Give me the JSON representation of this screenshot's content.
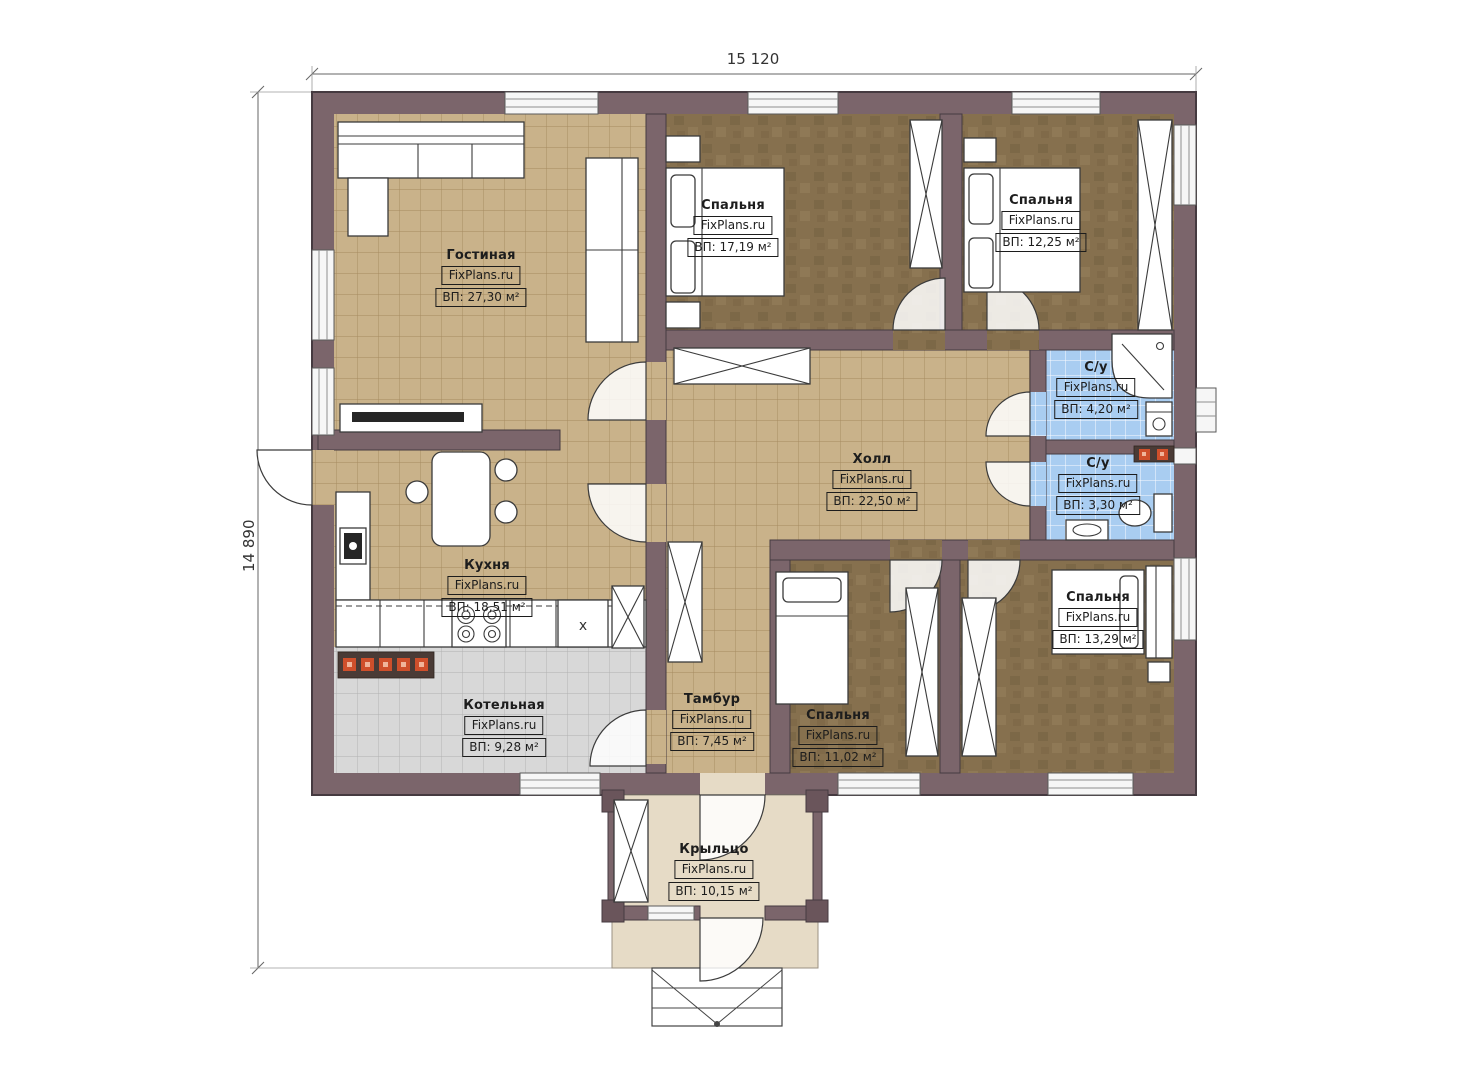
{
  "dimensions": {
    "width": "15 120",
    "height": "14 890"
  },
  "watermark": "FixPlans.ru",
  "kitchen_marker": "x",
  "rooms": [
    {
      "key": "living",
      "name": "Гостиная",
      "area": "ВП: 27,30 м²"
    },
    {
      "key": "bedroom-1",
      "name": "Спальня",
      "area": "ВП: 17,19 м²"
    },
    {
      "key": "bedroom-2",
      "name": "Спальня",
      "area": "ВП: 12,25 м²"
    },
    {
      "key": "bath-1",
      "name": "С/у",
      "area": "ВП: 4,20 м²"
    },
    {
      "key": "bath-2",
      "name": "С/у",
      "area": "ВП: 3,30 м²"
    },
    {
      "key": "hall",
      "name": "Холл",
      "area": "ВП: 22,50 м²"
    },
    {
      "key": "kitchen",
      "name": "Кухня",
      "area": "ВП: 18,51 м²"
    },
    {
      "key": "boiler",
      "name": "Котельная",
      "area": "ВП: 9,28 м²"
    },
    {
      "key": "vestibule",
      "name": "Тамбур",
      "area": "ВП: 7,45 м²"
    },
    {
      "key": "bedroom-3",
      "name": "Спальня",
      "area": "ВП: 11,02 м²"
    },
    {
      "key": "bedroom-4",
      "name": "Спальня",
      "area": "ВП: 13,29 м²"
    },
    {
      "key": "porch",
      "name": "Крыльцо",
      "area": "ВП: 10,15 м²"
    }
  ],
  "colors": {
    "wall": "#7b656b",
    "wall-dark": "#453a40",
    "floor-beige": "#c9b28a",
    "beige-grid": "#a5895f",
    "floor-wood": "#86704e",
    "floor-blue": "#a9cdf1",
    "floor-gray": "#d8d8d8",
    "gray-grid": "#b0b0b0",
    "floor-porch": "#e6dbc6",
    "accent-orange": "#cf4f2b"
  }
}
